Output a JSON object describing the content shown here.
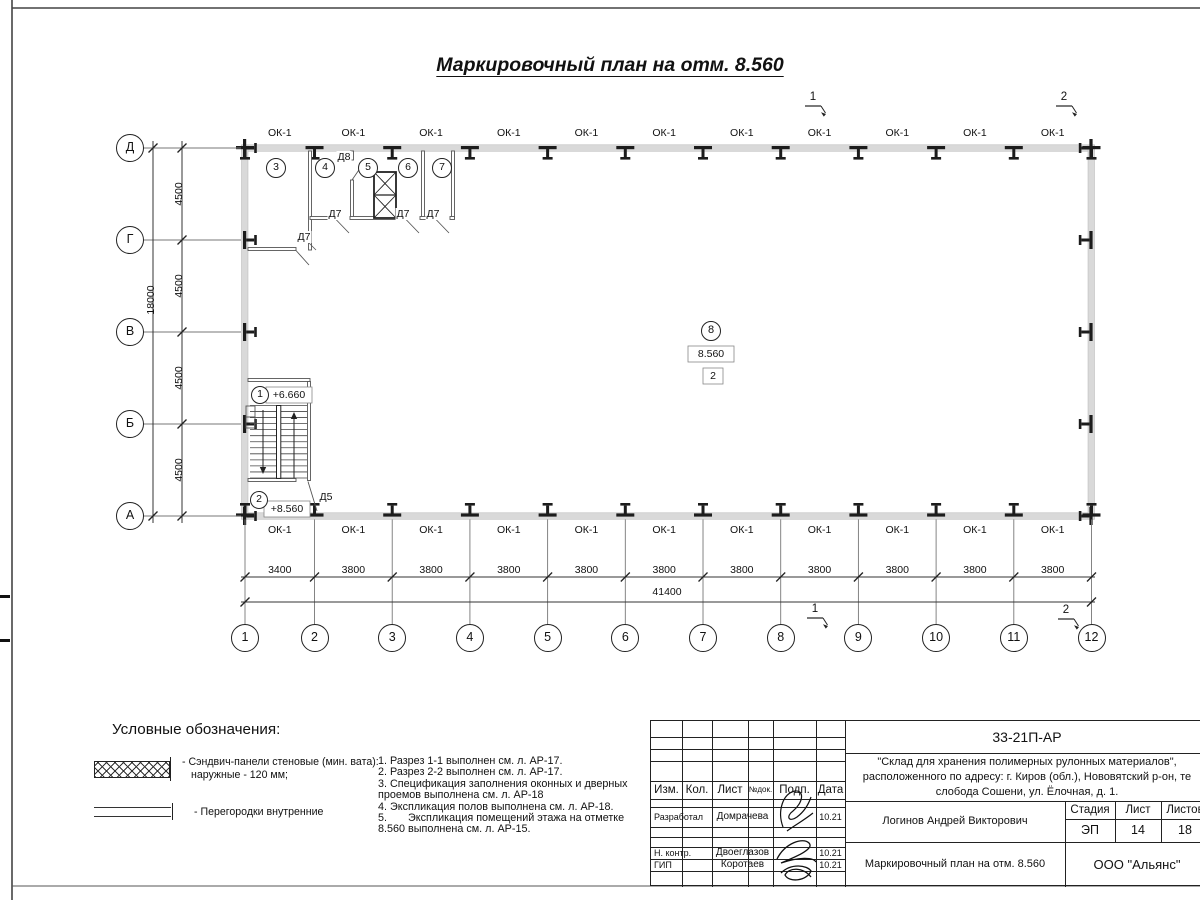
{
  "title": "Маркировочный план на отм. 8.560",
  "plan": {
    "window_label": "ОК-1",
    "axes_bottom": [
      "1",
      "2",
      "3",
      "4",
      "5",
      "6",
      "7",
      "8",
      "9",
      "10",
      "11",
      "12"
    ],
    "axes_left": [
      "Д",
      "Г",
      "В",
      "Б",
      "А"
    ],
    "dims_bottom": [
      "3400",
      "3800",
      "3800",
      "3800",
      "3800",
      "3800",
      "3800",
      "3800",
      "3800",
      "3800",
      "3800"
    ],
    "dim_total_bottom": "41400",
    "dims_left": [
      "4500",
      "4500",
      "4500",
      "4500"
    ],
    "dim_total_left": "18000",
    "section_marks": [
      "1",
      "2"
    ],
    "room_marks": {
      "top_rooms": [
        "3",
        "4",
        "5",
        "6",
        "7"
      ],
      "stair_upper": "1",
      "stair_lower": "2",
      "hall": "8"
    },
    "elevations": {
      "stair_upper": "+6.660",
      "stair_lower": "+8.560",
      "hall": "8.560",
      "hall_note": "2"
    },
    "doors": {
      "d5": "Д5",
      "d7": "Д7",
      "d8": "Д8"
    }
  },
  "legend": {
    "heading": "Условные обозначения:",
    "items": [
      {
        "line1": "- Сэндвич-панели стеновые (мин. вата):",
        "line2": "наружные - 120 мм;"
      },
      {
        "line1": "- Перегородки внутренние"
      }
    ]
  },
  "notes": [
    "1. Разрез 1-1 выполнен см. л. АР-17.",
    "2. Разрез 2-2 выполнен см. л. АР-17.",
    "3. Спецификация заполнения оконных и дверных",
    "проемов выполнена см. л. АР-18",
    "4. Экспликация полов выполнена см. л. АР-18.",
    "5.       Экспликация помещений этажа на отметке",
    "8.560 выполнена см. л. АР-15."
  ],
  "titleblock": {
    "code": "33-21П-АР",
    "project_line1": "\"Склад для хранения полимерных рулонных материалов\",",
    "project_line2": "расположенного по адресу: г. Киров (обл.), Нововятский р-он, те",
    "project_line3": "слобода Сошени, ул. Ёлочная, д. 1.",
    "cols": {
      "izm": "Изм.",
      "kol": "Кол.",
      "list": "Лист",
      "ndok": "№док.",
      "podp": "Подп.",
      "data": "Дата"
    },
    "rows": [
      {
        "role": "Разработал",
        "name": "Домрачева",
        "date": "10.21"
      },
      {
        "role": "Н. контр.",
        "name": "Двоеглазов",
        "date": "10.21"
      },
      {
        "role": "ГИП",
        "name": "Коротаев",
        "date": "10.21"
      }
    ],
    "chief": "Логинов Андрей Викторович",
    "stage_label": "Стадия",
    "sheet_label": "Лист",
    "sheets_label": "Листов",
    "stage": "ЭП",
    "sheet": "14",
    "sheets": "18",
    "doc_title": "Маркировочный план на отм. 8.560",
    "company": "ООО \"Альянс\""
  }
}
